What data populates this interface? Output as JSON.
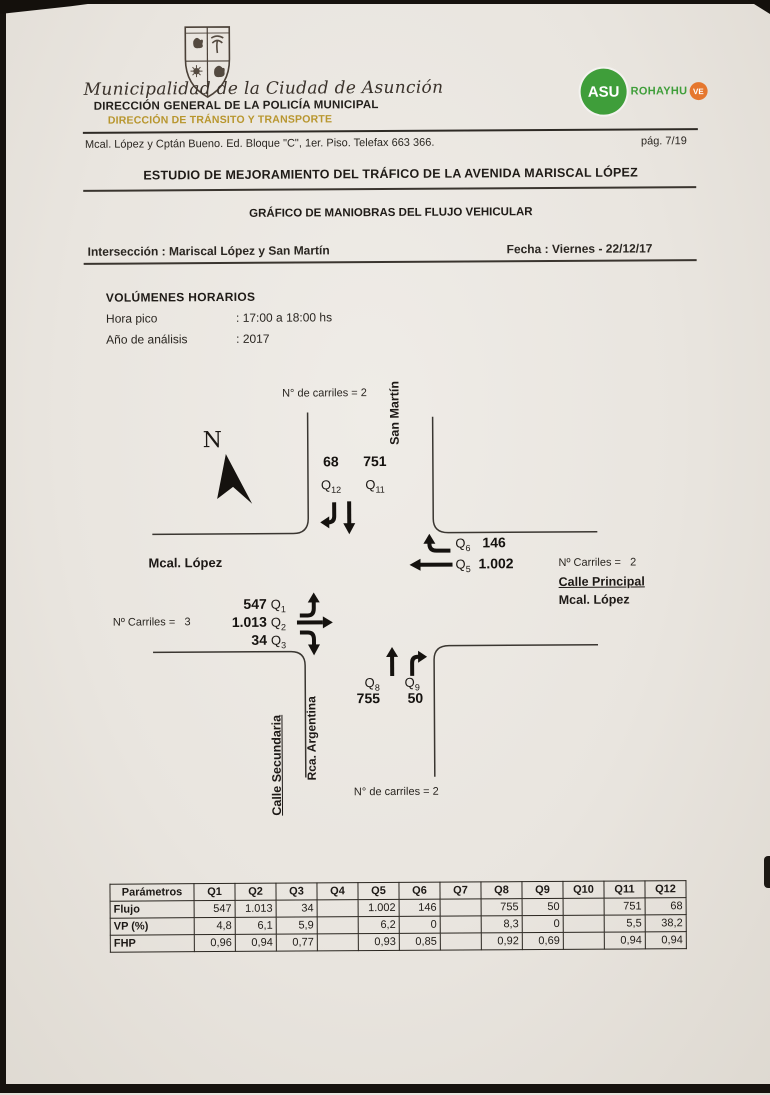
{
  "header": {
    "crest_icon": "municipal-crest",
    "institution": "Municipalidad de la Ciudad de Asunción",
    "direccion_general": "DIRECCIÓN GENERAL DE LA POLICÍA MUNICIPAL",
    "direccion_transito": "DIRECCIÓN DE TRÁNSITO Y TRANSPORTE",
    "logo": {
      "asu": "ASU",
      "rohayhu": "ROHAYHU",
      "ve": "VE",
      "green": "#3f9e3a",
      "orange": "#e5772e"
    },
    "address": "Mcal. López y Cptán Bueno. Ed. Bloque \"C\", 1er. Piso. Telefax 663 366.",
    "page_number": "pág. 7/19"
  },
  "titles": {
    "main": "ESTUDIO DE MEJORAMIENTO DEL TRÁFICO DE LA AVENIDA MARISCAL LÓPEZ",
    "sub": "GRÁFICO DE MANIOBRAS DEL FLUJO VEHICULAR",
    "intersection": "Intersección : Mariscal López y San Martín",
    "date": "Fecha : Viernes - 22/12/17"
  },
  "volumes": {
    "heading": "VOLÚMENES  HORARIOS",
    "rows": [
      {
        "label": "Hora pico",
        "value": ": 17:00 a 18:00 hs"
      },
      {
        "label": "Año de análisis",
        "value": ": 2017"
      }
    ]
  },
  "diagram": {
    "north": "N",
    "lanes_top": "N° de carriles = 2",
    "lanes_bottom": "N° de carriles = 2",
    "lanes_left": "Nº Carriles =   3",
    "lanes_right": "Nº Carriles =   2",
    "streets": {
      "top": "San Martín",
      "left": "Mcal. López",
      "right_role": "Calle Principal",
      "right_name": "Mcal. López",
      "bottom_role": "Calle Secundaria",
      "bottom_name": "Rca. Argentina"
    },
    "flows": {
      "q1": {
        "q": "Q",
        "sub": "1",
        "value": "547"
      },
      "q2": {
        "q": "Q",
        "sub": "2",
        "value": "1.013"
      },
      "q3": {
        "q": "Q",
        "sub": "3",
        "value": "34"
      },
      "q5": {
        "q": "Q",
        "sub": "5",
        "value": "1.002"
      },
      "q6": {
        "q": "Q",
        "sub": "6",
        "value": "146"
      },
      "q8": {
        "q": "Q",
        "sub": "8",
        "value": "755"
      },
      "q9": {
        "q": "Q",
        "sub": "9",
        "value": "50"
      },
      "q11": {
        "q": "Q",
        "sub": "11",
        "value": "751"
      },
      "q12": {
        "q": "Q",
        "sub": "12",
        "value": "68"
      }
    }
  },
  "table": {
    "headers": [
      "Parámetros",
      "Q1",
      "Q2",
      "Q3",
      "Q4",
      "Q5",
      "Q6",
      "Q7",
      "Q8",
      "Q9",
      "Q10",
      "Q11",
      "Q12"
    ],
    "rows": [
      {
        "name": "Flujo",
        "values": [
          "547",
          "1.013",
          "34",
          "",
          "1.002",
          "146",
          "",
          "755",
          "50",
          "",
          "751",
          "68"
        ]
      },
      {
        "name": "VP (%)",
        "values": [
          "4,8",
          "6,1",
          "5,9",
          "",
          "6,2",
          "0",
          "",
          "8,3",
          "0",
          "",
          "5,5",
          "38,2"
        ]
      },
      {
        "name": "FHP",
        "values": [
          "0,96",
          "0,94",
          "0,77",
          "",
          "0,93",
          "0,85",
          "",
          "0,92",
          "0,69",
          "",
          "0,94",
          "0,94"
        ]
      }
    ]
  }
}
